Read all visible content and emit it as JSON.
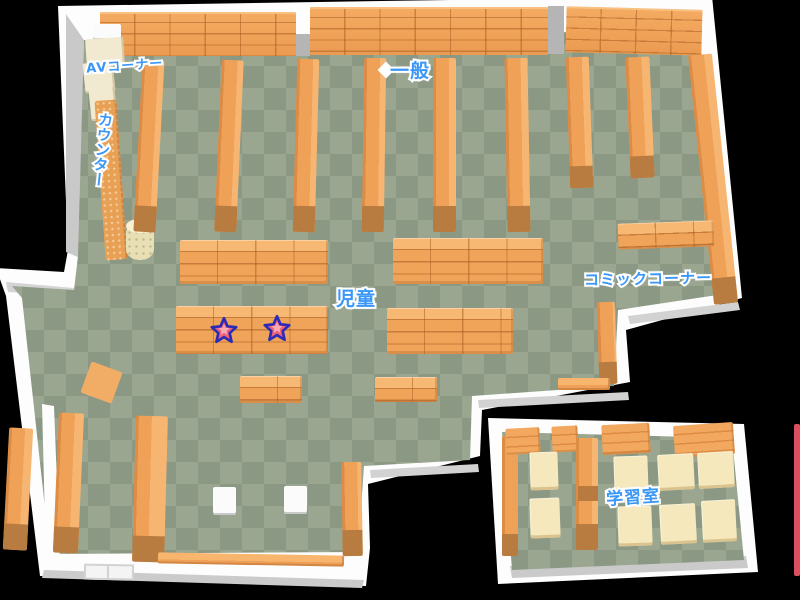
{
  "title": "library-floor-map",
  "background": "#000000",
  "areas": {
    "av_corner": {
      "label": "AVコーナー"
    },
    "general": {
      "label": "一般"
    },
    "counter": {
      "label": "カウンター"
    },
    "children": {
      "label": "児童"
    },
    "comic_corner": {
      "label": "コミックコーナー"
    },
    "study_room": {
      "label": "学習室"
    }
  },
  "markers": {
    "stars": [
      {
        "name": "star-marker",
        "area": "children"
      },
      {
        "name": "star-marker",
        "area": "children"
      }
    ]
  },
  "colors": {
    "floor_light": "#9aa68f",
    "floor_dark": "#8b9884",
    "shelf_orange": "#f0a45a",
    "shelf_end_cap": "#b87c41",
    "wall_white": "#ffffff",
    "wall_shade": "#c9c9c9",
    "label_blue": "#3a97f8",
    "star_fill": "#ee6177",
    "star_outline": "#2b2bb8",
    "desk_cream": "#f5e8bd",
    "av_shelf_cream": "#f2ead0",
    "edge_accent_pink": "#dd4f5e",
    "pillar_gray": "#b5b5b5"
  }
}
